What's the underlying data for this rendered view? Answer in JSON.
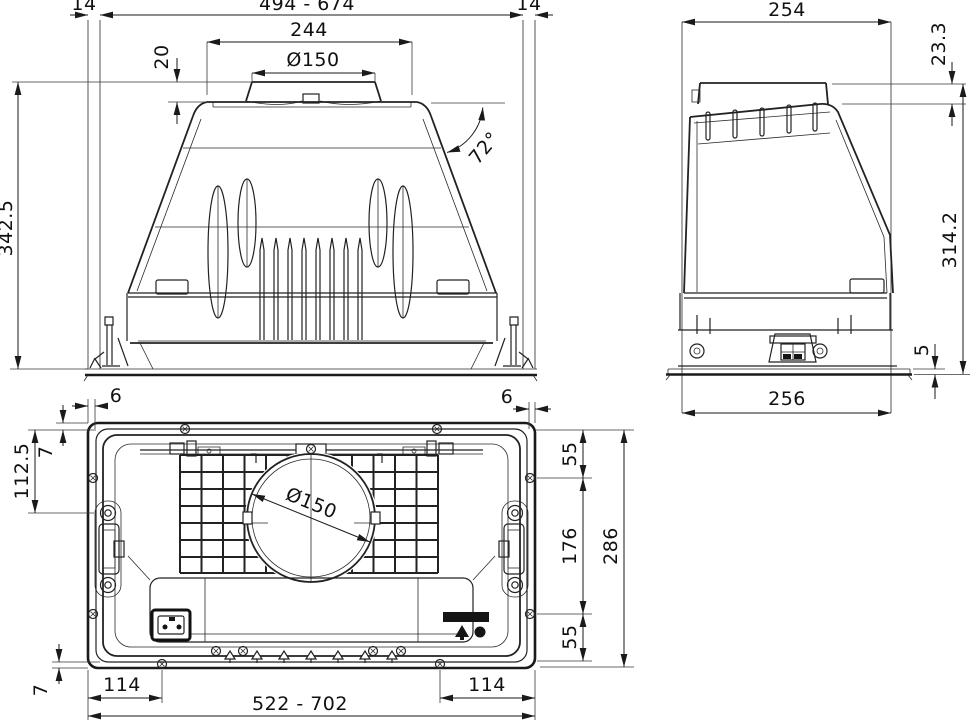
{
  "front_view": {
    "gap_left": "14",
    "width_range": "494 - 674",
    "gap_right": "14",
    "top_width": "244",
    "duct_diameter": "Ø150",
    "collar_height": "20",
    "angle": "72°",
    "overall_height": "342.5"
  },
  "side_view": {
    "depth": "254",
    "collar_drop": "23.3",
    "body_height": "314.2",
    "flange_thickness": "5",
    "base_depth": "256"
  },
  "bottom_view": {
    "flange_edge_left": "6",
    "flange_edge_right": "6",
    "lip_top": "7",
    "latch_offset": "112.5",
    "hole_offset_top": "55",
    "hole_spacing": "176",
    "cutout_depth": "286",
    "hole_offset_bottom": "55",
    "duct_diameter": "Ø150",
    "screw_inset_left": "114",
    "screw_inset_right": "114",
    "width_range": "522 - 702",
    "lip_bottom": "7"
  },
  "icons": {
    "power_socket": "power-socket-icon",
    "lamp_symbol": "lamp-symbol-icon",
    "motor_symbol": "motor-dot-symbol-icon",
    "rating_label": "rating-label"
  },
  "colors": {
    "line": "#1a1a1a",
    "background": "#ffffff"
  }
}
